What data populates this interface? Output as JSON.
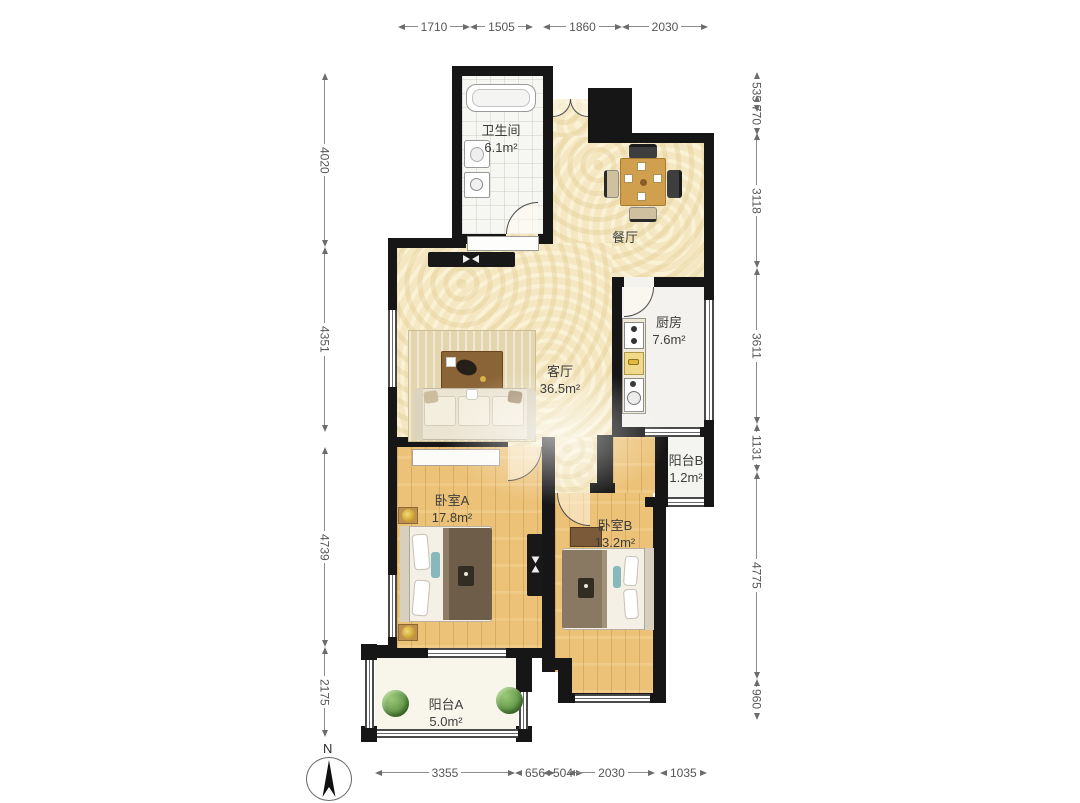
{
  "plan_title": "两室两厅户型图",
  "rooms": [
    {
      "name": "卫生间",
      "area": "6.1m²"
    },
    {
      "name": "餐厅",
      "area": ""
    },
    {
      "name": "厨房",
      "area": "7.6m²"
    },
    {
      "name": "客厅",
      "area": "36.5m²"
    },
    {
      "name": "阳台B",
      "area": "1.2m²"
    },
    {
      "name": "卧室A",
      "area": "17.8m²"
    },
    {
      "name": "卧室B",
      "area": "13.2m²"
    },
    {
      "name": "阳台A",
      "area": "5.0m²"
    }
  ],
  "dimensions_mm": {
    "top": [
      "1710",
      "1505",
      "1860",
      "2030"
    ],
    "bottom": [
      "3355",
      "656",
      "504",
      "2030",
      "1035"
    ],
    "left": [
      "4020",
      "4351",
      "4739",
      "2175"
    ],
    "right": [
      "535",
      "770",
      "3118",
      "3611",
      "1131",
      "4775",
      "960"
    ]
  },
  "compass": {
    "label": "N"
  },
  "colors": {
    "wall": "#161616",
    "floor_living": "#f4e7c2",
    "floor_wood": "#ecc278",
    "floor_tile": "#f6f6f2",
    "floor_kitchen": "#f3f2ee",
    "floor_balconyA": "#f8f6ea",
    "floor_balconyB": "#f4f4f0",
    "dim_text": "#565656",
    "label_text": "#3c3c3c",
    "table_wood": "#d0a04e",
    "plant": "#679b4c"
  }
}
